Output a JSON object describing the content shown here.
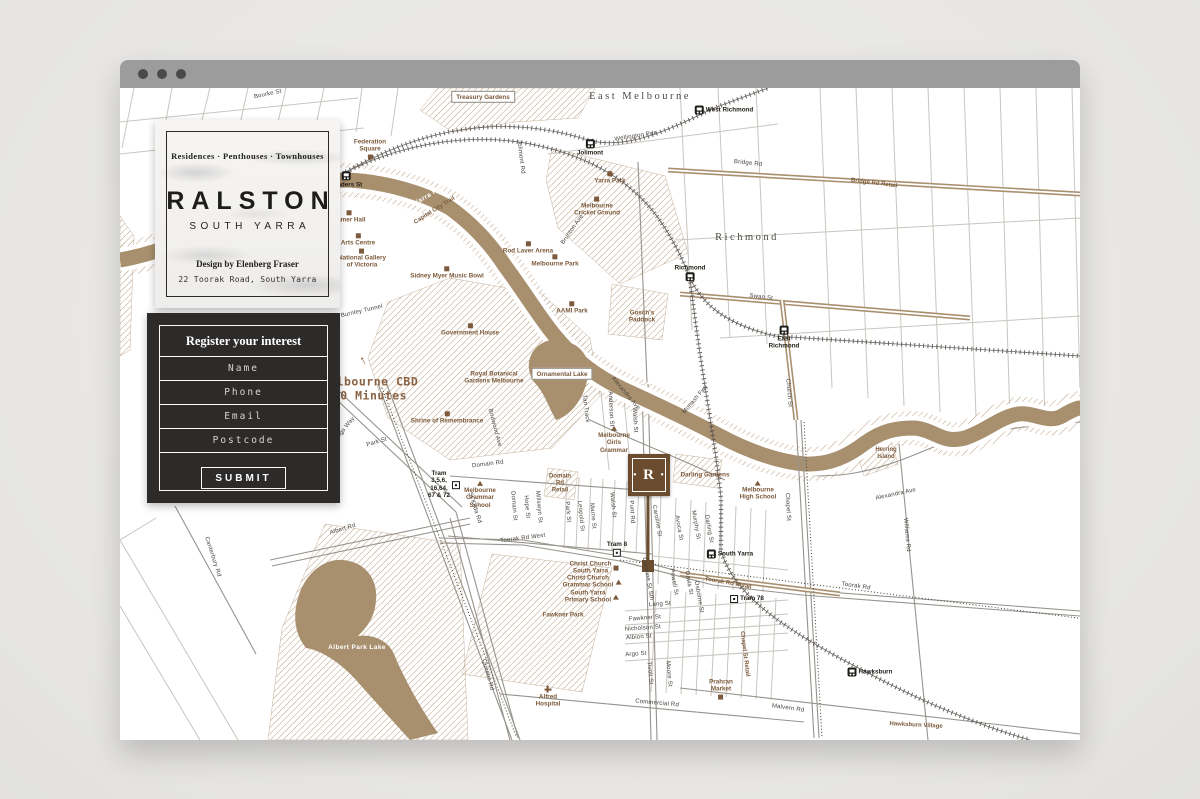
{
  "colors": {
    "chrome": "#9c9c9c",
    "panel": "#2d2a2a",
    "brown": "#a8906f",
    "marker_brown": "#6b4c2e",
    "label_brown": "#7c5a3b",
    "hatch": "#bb9f82",
    "page_bg": "#eae9e7"
  },
  "browser_chrome": {
    "control_dots": 3
  },
  "brand_card": {
    "tagline": "Residences · Penthouses · Townhouses",
    "title": "RALSTON",
    "subtitle": "SOUTH YARRA",
    "designer": "Design by Elenberg Fraser",
    "address": "22 Toorak Road, South Yarra"
  },
  "form": {
    "title": "Register your interest",
    "fields": [
      {
        "placeholder": "Name"
      },
      {
        "placeholder": "Phone"
      },
      {
        "placeholder": "Email"
      },
      {
        "placeholder": "Postcode"
      }
    ],
    "submit_label": "SUBMIT"
  },
  "map": {
    "marker": {
      "label": "· R ·"
    },
    "labels": [
      {
        "t": "East Melbourne",
        "x": 520,
        "y": 9,
        "c": "area",
        "n": "area-label-east-melbourne"
      },
      {
        "t": "Richmond",
        "x": 627,
        "y": 150,
        "c": "area",
        "n": "area-label-richmond"
      },
      {
        "t": "Treasury Gardens",
        "x": 363,
        "y": 9,
        "c": "boxed",
        "n": "park-label-treasury-gardens"
      },
      {
        "t": "Ornamental Lake",
        "x": 442,
        "y": 286,
        "c": "boxed",
        "n": "lake-label-ornamental-lake"
      },
      {
        "t": "Albert Park Lake",
        "x": 237,
        "y": 560,
        "c": "water",
        "n": "lake-label-albert-park-lake"
      },
      {
        "t": "Yarra River",
        "x": 312,
        "y": 106,
        "r": -31,
        "c": "water",
        "n": "river-label"
      },
      {
        "t": "Capital City Trail",
        "x": 315,
        "y": 123,
        "r": -32,
        "c": "bstreet"
      },
      {
        "t": "Herring\nIsland",
        "x": 766,
        "y": 366,
        "c": "bstreet"
      },
      {
        "t": "Hawksburn Village",
        "x": 796,
        "y": 638,
        "r": 3,
        "c": "bstreet"
      },
      {
        "t": "Domain\nRd\nRetail",
        "x": 440,
        "y": 396,
        "c": "bstreet"
      },
      {
        "t": "Chapel St Retail",
        "x": 624,
        "y": 566,
        "r": 83,
        "c": "bstreet"
      },
      {
        "t": "Toorak Rd Retail",
        "x": 608,
        "y": 496,
        "r": 10,
        "c": "bstreet"
      },
      {
        "t": "Bridge Rd Retail",
        "x": 754,
        "y": 96,
        "r": 7,
        "c": "bstreet"
      },
      {
        "t": "Melbourne CBD\n10 Minutes",
        "x": 250,
        "y": 301,
        "c": "cbd",
        "n": "cbd-distance-note"
      },
      {
        "t": "↑",
        "x": 243,
        "y": 272,
        "r": -28,
        "c": "cbd-arrow",
        "n": "cbd-arrow-icon"
      },
      {
        "t": "Federation\nSquare",
        "x": 250,
        "y": 61,
        "c": "lm",
        "icon": "sq",
        "ip": "below"
      },
      {
        "t": "Hamer Hall",
        "x": 229,
        "y": 129,
        "c": "lm",
        "icon": "sq",
        "ip": "above"
      },
      {
        "t": "Arts Centre",
        "x": 238,
        "y": 152,
        "c": "lm",
        "icon": "sq",
        "ip": "above"
      },
      {
        "t": "National Gallery\nof Victoria",
        "x": 242,
        "y": 171,
        "c": "lm",
        "icon": "sq",
        "ip": "above"
      },
      {
        "t": "Sidney Myer Music Bowl",
        "x": 327,
        "y": 185,
        "c": "lm",
        "icon": "sq",
        "ip": "above"
      },
      {
        "t": "Rod Laver Arena",
        "x": 408,
        "y": 160,
        "c": "lm",
        "icon": "sq",
        "ip": "above"
      },
      {
        "t": "Melbourne Park",
        "x": 435,
        "y": 173,
        "c": "lm",
        "icon": "sq",
        "ip": "above"
      },
      {
        "t": "Melbourne\nCricket Ground",
        "x": 477,
        "y": 119,
        "c": "lm",
        "icon": "sq",
        "ip": "above"
      },
      {
        "t": "Yarra Park",
        "x": 490,
        "y": 90,
        "c": "lm",
        "icon": "sq",
        "ip": "above"
      },
      {
        "t": "AAMI Park",
        "x": 452,
        "y": 220,
        "c": "lm",
        "icon": "sq",
        "ip": "above"
      },
      {
        "t": "Gosch's\nPaddock",
        "x": 522,
        "y": 229,
        "c": "lm"
      },
      {
        "t": "Government House",
        "x": 350,
        "y": 242,
        "c": "lm",
        "icon": "sq",
        "ip": "above"
      },
      {
        "t": "Royal Botanical\nGardens Melbourne",
        "x": 374,
        "y": 290,
        "c": "lm"
      },
      {
        "t": "Shrine of Remembrance",
        "x": 327,
        "y": 330,
        "c": "lm",
        "icon": "sq",
        "ip": "above"
      },
      {
        "t": "Melbourne\nGirls\nGrammar",
        "x": 494,
        "y": 352,
        "c": "lm",
        "icon": "tri",
        "ip": "above"
      },
      {
        "t": "Darling Gardens",
        "x": 585,
        "y": 387,
        "c": "lm"
      },
      {
        "t": "Melbourne\nHigh School",
        "x": 638,
        "y": 403,
        "c": "lm",
        "icon": "tri",
        "ip": "above"
      },
      {
        "t": "Christ Church\nSouth Yarra",
        "x": 474,
        "y": 480,
        "c": "lm",
        "icon": "sq",
        "ip": "right"
      },
      {
        "t": "Christ Church\nGrammar School",
        "x": 472,
        "y": 494,
        "c": "lm",
        "icon": "tri",
        "ip": "right"
      },
      {
        "t": "South Yarra\nPrimary School",
        "x": 472,
        "y": 509,
        "c": "lm",
        "icon": "tri",
        "ip": "right"
      },
      {
        "t": "Fawkner Park",
        "x": 443,
        "y": 527,
        "c": "lm"
      },
      {
        "t": "Alfred\nHospital",
        "x": 428,
        "y": 609,
        "c": "lm",
        "icon": "cross",
        "ip": "above"
      },
      {
        "t": "Prahran\nMarket",
        "x": 601,
        "y": 601,
        "c": "lm",
        "icon": "sq",
        "ip": "below"
      },
      {
        "t": "Melbourne\nGrammar\nSchool",
        "x": 360,
        "y": 407,
        "c": "lm",
        "icon": "tri",
        "ip": "above"
      },
      {
        "t": "Flinders St",
        "x": 226,
        "y": 92,
        "c": "stn",
        "icon": "station",
        "ip": "above",
        "n": "station-flinders-st"
      },
      {
        "t": "Jolimont",
        "x": 470,
        "y": 60,
        "c": "stn",
        "icon": "station",
        "ip": "above",
        "n": "station-jolimont"
      },
      {
        "t": "West Richmond",
        "x": 604,
        "y": 22,
        "c": "stn",
        "icon": "station",
        "ip": "left",
        "n": "station-west-richmond"
      },
      {
        "t": "Richmond",
        "x": 570,
        "y": 185,
        "c": "stn",
        "icon": "station",
        "ip": "below",
        "n": "station-richmond"
      },
      {
        "t": "East\nRichmond",
        "x": 664,
        "y": 250,
        "c": "stn",
        "icon": "station",
        "ip": "above",
        "n": "station-east-richmond"
      },
      {
        "t": "South Yarra",
        "x": 610,
        "y": 466,
        "c": "stn",
        "icon": "station",
        "ip": "left",
        "n": "station-south-yarra"
      },
      {
        "t": "Hawksburn",
        "x": 750,
        "y": 584,
        "c": "stn",
        "icon": "station",
        "ip": "left",
        "n": "station-hawksburn"
      },
      {
        "t": "Tram 8",
        "x": 497,
        "y": 461,
        "c": "stn",
        "icon": "tram",
        "ip": "below",
        "n": "tram-stop-8"
      },
      {
        "t": "Tram\n3,5,6,\n16,64,\n67 & 72",
        "x": 324,
        "y": 397,
        "c": "stn",
        "icon": "tram",
        "ip": "right",
        "n": "tram-routes"
      },
      {
        "t": "Tram 78",
        "x": 627,
        "y": 511,
        "c": "stn",
        "icon": "tram",
        "ip": "left",
        "n": "tram-stop-78"
      },
      {
        "t": "Bourke St",
        "x": 148,
        "y": 7,
        "r": -12
      },
      {
        "t": "Wellington Pde",
        "x": 516,
        "y": 49,
        "r": -9
      },
      {
        "t": "Jolimont Rd",
        "x": 400,
        "y": 69,
        "r": 83
      },
      {
        "t": "Brunton Ave",
        "x": 453,
        "y": 142,
        "r": -55
      },
      {
        "t": "Bridge Rd",
        "x": 628,
        "y": 76,
        "r": 6
      },
      {
        "t": "Swan St",
        "x": 641,
        "y": 210,
        "r": 7
      },
      {
        "t": "Church St",
        "x": 668,
        "y": 305,
        "r": 85
      },
      {
        "t": "Monash Fwy",
        "x": 576,
        "y": 312,
        "r": -50
      },
      {
        "t": "Alexandra Ave",
        "x": 505,
        "y": 306,
        "r": 50
      },
      {
        "t": "Alexandra Ave",
        "x": 776,
        "y": 407,
        "r": -12
      },
      {
        "t": "Burnley Tunnel",
        "x": 242,
        "y": 224,
        "r": -13
      },
      {
        "t": "Anderson St",
        "x": 490,
        "y": 321,
        "r": 87
      },
      {
        "t": "Walsh St",
        "x": 514,
        "y": 332,
        "r": 87
      },
      {
        "t": "Tan Track",
        "x": 465,
        "y": 321,
        "r": 83
      },
      {
        "t": "Birdwood Ave",
        "x": 374,
        "y": 340,
        "r": 75
      },
      {
        "t": "Punt Rd",
        "x": 511,
        "y": 424,
        "r": 87
      },
      {
        "t": "Caroline St",
        "x": 536,
        "y": 433,
        "r": 80
      },
      {
        "t": "Avoca St",
        "x": 558,
        "y": 440,
        "r": 80
      },
      {
        "t": "Murphy St",
        "x": 575,
        "y": 437,
        "r": 80
      },
      {
        "t": "Darling St",
        "x": 588,
        "y": 441,
        "r": 80
      },
      {
        "t": "Park St",
        "x": 447,
        "y": 424,
        "r": 85
      },
      {
        "t": "Leopold St",
        "x": 460,
        "y": 428,
        "r": 85
      },
      {
        "t": "Marne St",
        "x": 472,
        "y": 428,
        "r": 85
      },
      {
        "t": "Walsh St",
        "x": 492,
        "y": 417,
        "r": 85
      },
      {
        "t": "Domain St",
        "x": 393,
        "y": 418,
        "r": 85
      },
      {
        "t": "Hope St",
        "x": 406,
        "y": 419,
        "r": 85
      },
      {
        "t": "Millswyn St",
        "x": 418,
        "y": 419,
        "r": 85
      },
      {
        "t": "Chapel St",
        "x": 667,
        "y": 419,
        "r": 87
      },
      {
        "t": "Domain Rd",
        "x": 368,
        "y": 377,
        "r": -7
      },
      {
        "t": "Toorak Rd West",
        "x": 403,
        "y": 451,
        "r": -7
      },
      {
        "t": "Toorak Rd",
        "x": 736,
        "y": 499,
        "r": 8
      },
      {
        "t": "St Kilda Rd",
        "x": 354,
        "y": 420,
        "r": 72
      },
      {
        "t": "Caroline St Sth",
        "x": 527,
        "y": 491,
        "r": 80
      },
      {
        "t": "Powell St",
        "x": 553,
        "y": 494,
        "r": 80
      },
      {
        "t": "Davis St",
        "x": 568,
        "y": 495,
        "r": 80
      },
      {
        "t": "Osborne St",
        "x": 578,
        "y": 509,
        "r": 80
      },
      {
        "t": "Lang St",
        "x": 540,
        "y": 517,
        "r": -4
      },
      {
        "t": "Fawkner St",
        "x": 525,
        "y": 531,
        "r": -4
      },
      {
        "t": "Nicholson St",
        "x": 523,
        "y": 541,
        "r": -4
      },
      {
        "t": "Albion St",
        "x": 519,
        "y": 550,
        "r": -4
      },
      {
        "t": "Argo St",
        "x": 516,
        "y": 567,
        "r": -4
      },
      {
        "t": "Tivoli St",
        "x": 529,
        "y": 585,
        "r": 85
      },
      {
        "t": "Moore St",
        "x": 548,
        "y": 586,
        "r": 85
      },
      {
        "t": "Commercial Rd",
        "x": 537,
        "y": 616,
        "r": 5
      },
      {
        "t": "Queens Rd",
        "x": 367,
        "y": 587,
        "r": 75
      },
      {
        "t": "Malvern Rd",
        "x": 668,
        "y": 621,
        "r": 8
      },
      {
        "t": "Williams Rd",
        "x": 786,
        "y": 447,
        "r": 85
      },
      {
        "t": "Albert Rd",
        "x": 223,
        "y": 442,
        "r": -17
      },
      {
        "t": "Canterbury Rd",
        "x": 92,
        "y": 469,
        "r": 72
      },
      {
        "t": "Kings Way",
        "x": 225,
        "y": 342,
        "r": -52
      },
      {
        "t": "Park St",
        "x": 257,
        "y": 355,
        "r": -17
      }
    ]
  }
}
